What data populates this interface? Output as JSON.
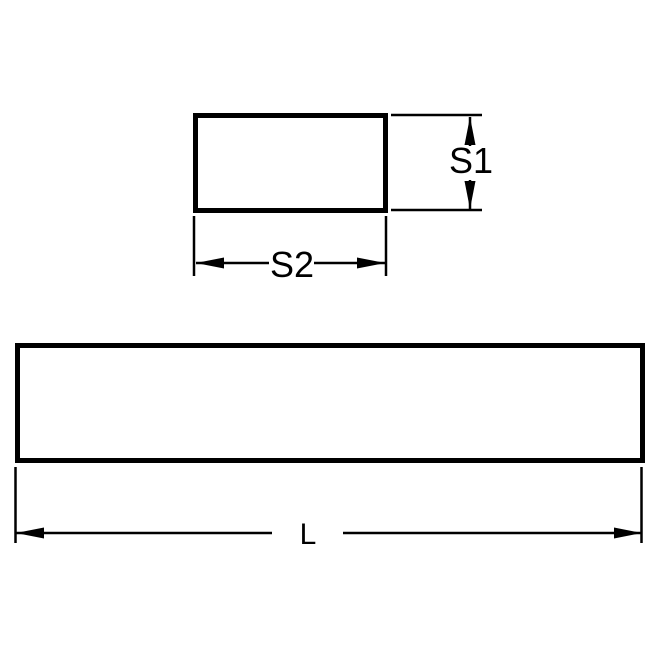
{
  "drawing": {
    "labels": {
      "s1": "S1",
      "s2": "S2",
      "l": "L"
    },
    "colors": {
      "line": "#000000",
      "background": "#ffffff"
    }
  }
}
